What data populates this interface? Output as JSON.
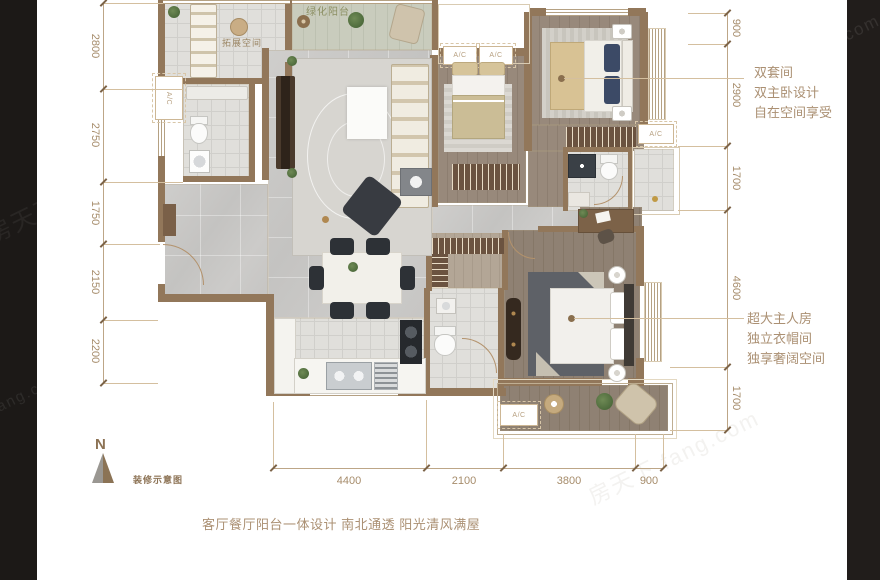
{
  "canvas": {
    "width": 880,
    "height": 580
  },
  "colors": {
    "background_band": "#1c1917",
    "wall": "#92775a",
    "dimension": "#a68c6b",
    "annotation": "#ab9073"
  },
  "plan": {
    "labels": {
      "green_balcony": "绿化阳台",
      "expand_space": "拓展空间",
      "ac": "A/C"
    }
  },
  "dimensions": {
    "left": [
      "2800",
      "2750",
      "1750",
      "2150",
      "2200"
    ],
    "right": [
      "900",
      "2900",
      "1700",
      "4600",
      "1700"
    ],
    "bottom": [
      "4400",
      "2100",
      "3800",
      "900"
    ]
  },
  "annotations": {
    "suite": {
      "line1": "双套间",
      "line2": "双主卧设计",
      "line3": "自在空间享受"
    },
    "master": {
      "line1": "超大主人房",
      "line2": "独立衣帽间",
      "line3": "独享奢阔空间"
    },
    "tagline": "客厅餐厅阳台一体设计 南北通透 阳光清风满屋"
  },
  "compass": {
    "letter": "N",
    "caption": "装修示意图"
  },
  "watermarks": {
    "brand_cn": "房天下",
    "brand_en": "fang.com",
    "combo": "房天下 fang.com",
    "fragment": "com"
  }
}
